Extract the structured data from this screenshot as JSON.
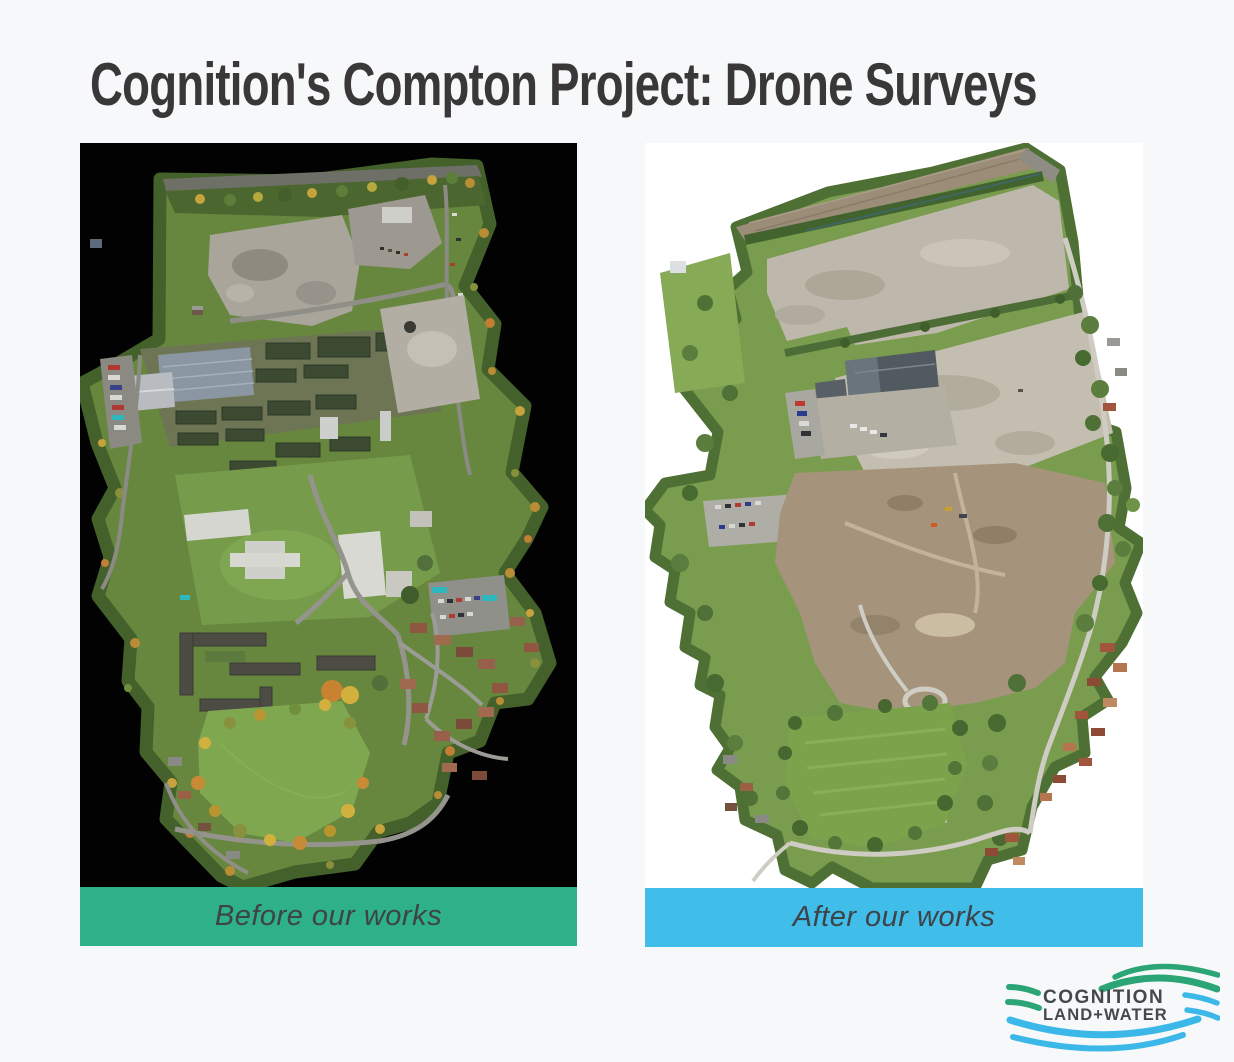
{
  "title": "Cognition's Compton Project: Drone Surveys",
  "panels": [
    {
      "id": "before",
      "caption": "Before our works",
      "bar_color": "#2eb187",
      "image_description": "Aerial drone orthomosaic of the Compton site before works: nursery buildings, glasshouses, demolition pads, winding roads, red-roofed housing and a large green meadow, shown on a black background"
    },
    {
      "id": "after",
      "caption": "After our works",
      "bar_color": "#41bde9",
      "image_description": "Aerial drone orthomosaic of the Compton site after works: cleared grey earth platforms, hedgerows, a retained depot building, neighbouring houses and a mown green field, shown on a white background"
    }
  ],
  "logo": {
    "line1": "COGNITION",
    "line2": "LAND+WATER",
    "wave_green": "#2ca576",
    "wave_blue": "#3cb8e8",
    "text_color": "#45484b"
  },
  "colors": {
    "page_background": "#f7f8fa",
    "title_text": "#3a3738",
    "caption_text": "#3e4347",
    "before_image_background": "#020202",
    "after_image_background": "#ffffff"
  }
}
